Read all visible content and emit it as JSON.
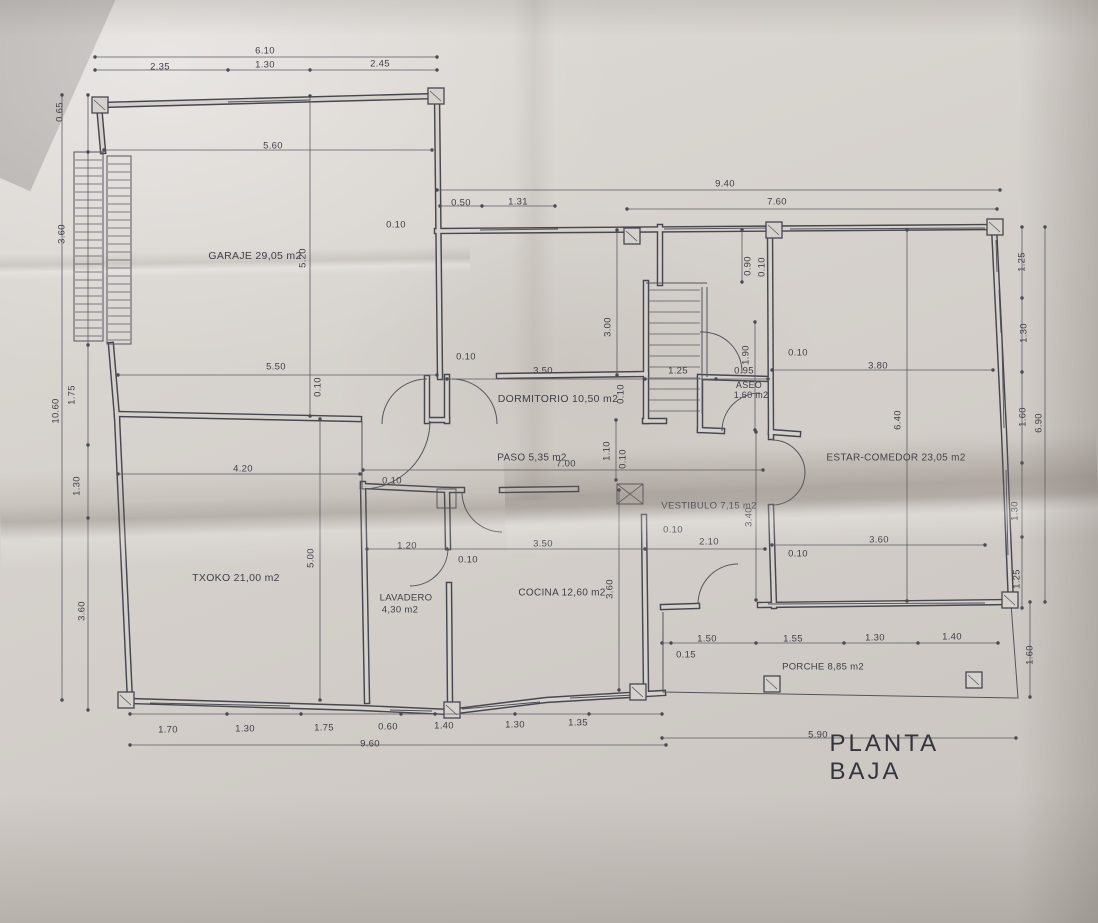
{
  "plan": {
    "title": "PLANTA BAJA",
    "room_labels": [
      {
        "name": "room-label-garaje",
        "text": "GARAJE 29,05 m2",
        "x": 255,
        "y": 256,
        "size": 10.5
      },
      {
        "name": "room-label-dormitorio",
        "text": "DORMITORIO 10,50 m2",
        "x": 558,
        "y": 399,
        "size": 10.5
      },
      {
        "name": "room-label-paso",
        "text": "PASO 5,35 m2",
        "x": 532,
        "y": 458,
        "size": 10
      },
      {
        "name": "room-label-aseo",
        "text": "ASEO",
        "x": 749,
        "y": 385,
        "size": 9
      },
      {
        "name": "room-label-aseo-area",
        "text": "1,60 m2",
        "x": 751,
        "y": 395,
        "size": 9
      },
      {
        "name": "room-label-vestibulo",
        "text": "VESTIBULO 7,15 m2",
        "x": 709,
        "y": 506,
        "size": 9.5
      },
      {
        "name": "room-label-estar-comedor",
        "text": "ESTAR-COMEDOR 23,05 m2",
        "x": 896,
        "y": 458,
        "size": 10
      },
      {
        "name": "room-label-txoko",
        "text": "TXOKO 21,00 m2",
        "x": 236,
        "y": 578,
        "size": 10.5
      },
      {
        "name": "room-label-lavadero",
        "text": "LAVADERO",
        "x": 406,
        "y": 598,
        "size": 9.5
      },
      {
        "name": "room-label-lavadero-area",
        "text": "4,30 m2",
        "x": 400,
        "y": 610,
        "size": 9.5
      },
      {
        "name": "room-label-cocina",
        "text": "COCINA 12,60 m2",
        "x": 562,
        "y": 593,
        "size": 10
      },
      {
        "name": "room-label-porche",
        "text": "PORCHE 8,85 m2",
        "x": 823,
        "y": 667,
        "size": 9.5
      }
    ],
    "dimension_labels": [
      {
        "text": "6.10",
        "x": 265,
        "y": 51
      },
      {
        "text": "2.35",
        "x": 160,
        "y": 67
      },
      {
        "text": "1.30",
        "x": 265,
        "y": 65
      },
      {
        "text": "2.45",
        "x": 380,
        "y": 64
      },
      {
        "text": "5.60",
        "x": 273,
        "y": 146
      },
      {
        "text": "9.40",
        "x": 725,
        "y": 184
      },
      {
        "text": "0.50",
        "x": 461,
        "y": 203
      },
      {
        "text": "1.31",
        "x": 518,
        "y": 202
      },
      {
        "text": "7.60",
        "x": 777,
        "y": 202
      },
      {
        "text": "0.10",
        "x": 396,
        "y": 225
      },
      {
        "text": "0.10",
        "x": 466,
        "y": 357
      },
      {
        "text": "5.50",
        "x": 276,
        "y": 367
      },
      {
        "text": "3.50",
        "x": 543,
        "y": 371
      },
      {
        "text": "1.25",
        "x": 678,
        "y": 371
      },
      {
        "text": "0.95",
        "x": 744,
        "y": 371
      },
      {
        "text": "0.10",
        "x": 798,
        "y": 353
      },
      {
        "text": "3.80",
        "x": 878,
        "y": 366
      },
      {
        "text": "4.20",
        "x": 243,
        "y": 469
      },
      {
        "text": "7.00",
        "x": 566,
        "y": 464
      },
      {
        "text": "0.10",
        "x": 392,
        "y": 481
      },
      {
        "text": "1.20",
        "x": 407,
        "y": 546
      },
      {
        "text": "3.50",
        "x": 543,
        "y": 544
      },
      {
        "text": "2.10",
        "x": 709,
        "y": 542
      },
      {
        "text": "0.10",
        "x": 673,
        "y": 530
      },
      {
        "text": "3.60",
        "x": 879,
        "y": 540
      },
      {
        "text": "0.10",
        "x": 798,
        "y": 554
      },
      {
        "text": "0.10",
        "x": 468,
        "y": 560
      },
      {
        "text": "1.50",
        "x": 707,
        "y": 639
      },
      {
        "text": "0.15",
        "x": 686,
        "y": 655
      },
      {
        "text": "1.55",
        "x": 793,
        "y": 639
      },
      {
        "text": "1.30",
        "x": 875,
        "y": 638
      },
      {
        "text": "1.40",
        "x": 952,
        "y": 637
      },
      {
        "text": "5.90",
        "x": 818,
        "y": 735
      },
      {
        "text": "1.70",
        "x": 168,
        "y": 730
      },
      {
        "text": "1.30",
        "x": 245,
        "y": 729
      },
      {
        "text": "1.75",
        "x": 324,
        "y": 728
      },
      {
        "text": "0.60",
        "x": 388,
        "y": 727
      },
      {
        "text": "1.40",
        "x": 444,
        "y": 726
      },
      {
        "text": "1.30",
        "x": 515,
        "y": 725
      },
      {
        "text": "1.35",
        "x": 578,
        "y": 723
      },
      {
        "text": "9.60",
        "x": 370,
        "y": 744
      },
      {
        "text": "0.65",
        "x": 60,
        "y": 112,
        "vertical": true
      },
      {
        "text": "3.60",
        "x": 62,
        "y": 234,
        "vertical": true
      },
      {
        "text": "1.75",
        "x": 72,
        "y": 395,
        "vertical": true
      },
      {
        "text": "10.60",
        "x": 56,
        "y": 411,
        "vertical": true
      },
      {
        "text": "1.30",
        "x": 77,
        "y": 486,
        "vertical": true
      },
      {
        "text": "3.60",
        "x": 82,
        "y": 611,
        "vertical": true
      },
      {
        "text": "5.20",
        "x": 303,
        "y": 258,
        "vertical": true
      },
      {
        "text": "0.10",
        "x": 318,
        "y": 387,
        "vertical": true
      },
      {
        "text": "3.00",
        "x": 608,
        "y": 327,
        "vertical": true
      },
      {
        "text": "0.10",
        "x": 621,
        "y": 394,
        "vertical": true
      },
      {
        "text": "1.10",
        "x": 607,
        "y": 451,
        "vertical": true
      },
      {
        "text": "0.10",
        "x": 623,
        "y": 459,
        "vertical": true
      },
      {
        "text": "0.90",
        "x": 748,
        "y": 266,
        "vertical": true
      },
      {
        "text": "0.10",
        "x": 762,
        "y": 267,
        "vertical": true
      },
      {
        "text": "1.90",
        "x": 746,
        "y": 355,
        "vertical": true
      },
      {
        "text": "3.40",
        "x": 749,
        "y": 517,
        "vertical": true
      },
      {
        "text": "6.40",
        "x": 898,
        "y": 420,
        "vertical": true
      },
      {
        "text": "5.00",
        "x": 311,
        "y": 558,
        "vertical": true
      },
      {
        "text": "3.60",
        "x": 610,
        "y": 589,
        "vertical": true
      },
      {
        "text": "1.25",
        "x": 1022,
        "y": 262,
        "vertical": true
      },
      {
        "text": "1.30",
        "x": 1024,
        "y": 333,
        "vertical": true
      },
      {
        "text": "1.60",
        "x": 1023,
        "y": 417,
        "vertical": true
      },
      {
        "text": "6.90",
        "x": 1039,
        "y": 423,
        "vertical": true
      },
      {
        "text": "1.30",
        "x": 1015,
        "y": 511,
        "vertical": true
      },
      {
        "text": "1.25",
        "x": 1017,
        "y": 579,
        "vertical": true
      },
      {
        "text": "1.60",
        "x": 1030,
        "y": 655,
        "vertical": true
      }
    ]
  }
}
